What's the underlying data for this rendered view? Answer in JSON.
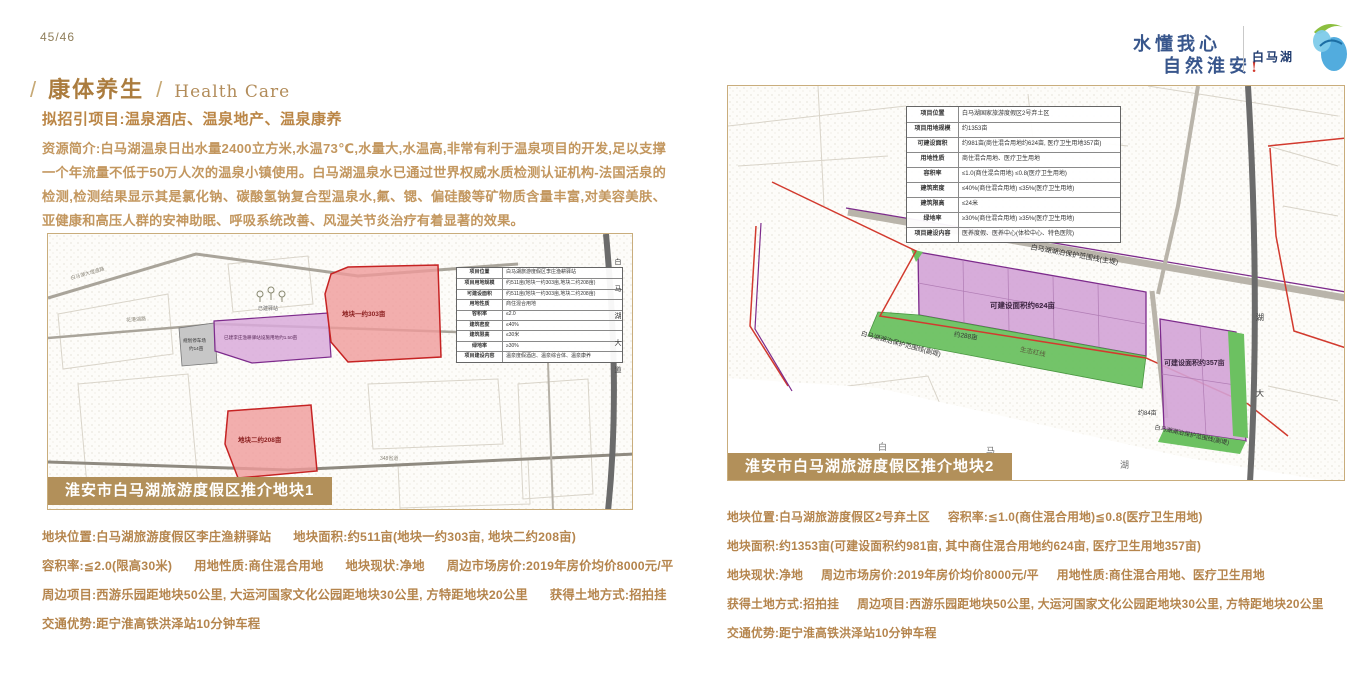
{
  "page": {
    "number": "45/46"
  },
  "header": {
    "slogan_line1": "水懂我心",
    "slogan_line2": "自然淮安",
    "slogan_mark": "!",
    "logo_text": "白马湖"
  },
  "section": {
    "slash": "/",
    "title_zh": "康体养生",
    "title_en": "Health Care",
    "subtitle": "拟招引项目:温泉酒店、温泉地产、温泉康养",
    "intro": "资源简介:白马湖温泉日出水量2400立方米,水温73℃,水量大,水温高,非常有利于温泉项目的开发,足以支撑一个年流量不低于50万人次的温泉小镇使用。白马湖温泉水已通过世界权威水质检测认证机构-法国活泉的检测,检测结果显示其是氯化钠、碳酸氢钠复合型温泉水,氟、锶、偏硅酸等矿物质含量丰富,对美容美肤、亚健康和高压人群的安神助眠、呼吸系统改善、风湿关节炎治疗有着显著的效果。"
  },
  "parcel1": {
    "caption": "淮安市白马湖旅游度假区推介地块1",
    "map_table": [
      {
        "k": "项目位置",
        "v": "白马湖旅游度假区李庄渔耕驿站"
      },
      {
        "k": "项目用地规模",
        "v": "约511亩(地块一约303亩,地块二约208亩)"
      },
      {
        "k": "可建设面积",
        "v": "约511亩(地块一约303亩,地块二约208亩)"
      },
      {
        "k": "用地性质",
        "v": "商住混合用地"
      },
      {
        "k": "容积率",
        "v": "≤2.0"
      },
      {
        "k": "建筑密度",
        "v": "≤40%"
      },
      {
        "k": "建筑限高",
        "v": "≤30米"
      },
      {
        "k": "绿地率",
        "v": "≥30%"
      },
      {
        "k": "项目建设内容",
        "v": "温泉度假酒店、温泉综合体、温泉康养"
      }
    ],
    "map_labels": {
      "road_top": "白马湖大堤道路",
      "road_mid": "花港湖路",
      "road_348": "348省道",
      "road_vertical": "白马湖大道",
      "parcel_a": "地块一约303亩",
      "parcel_b": "地块二约208亩",
      "built_station": "已建驿站",
      "built_strip": "已建李庄渔耕驿站设施用地约1.50亩",
      "parking_1": "规划停车场",
      "parking_2": "约14亩"
    },
    "details": [
      {
        "segments": [
          {
            "label": "地块位置:",
            "value": "白马湖旅游度假区李庄渔耕驿站"
          },
          {
            "label": "地块面积:",
            "value": "约511亩(地块一约303亩, 地块二约208亩)"
          }
        ]
      },
      {
        "segments": [
          {
            "label": "容积率:",
            "value": "≦2.0(限高30米)"
          },
          {
            "label": "用地性质:",
            "value": "商住混合用地"
          },
          {
            "label": "地块现状:",
            "value": "净地"
          },
          {
            "label": "周边市场房价:",
            "value": "2019年房价均价8000元/平"
          }
        ]
      },
      {
        "segments": [
          {
            "label": "周边项目:",
            "value": "西游乐园距地块50公里, 大运河国家文化公园距地块30公里, 方特距地块20公里"
          },
          {
            "label": "获得土地方式:",
            "value": "招拍挂"
          }
        ]
      },
      {
        "segments": [
          {
            "label": "交通优势:",
            "value": "距宁淮高铁洪泽站10分钟车程"
          }
        ]
      }
    ]
  },
  "parcel2": {
    "caption": "淮安市白马湖旅游度假区推介地块2",
    "map_table": [
      {
        "k": "项目位置",
        "v": "白马湖国家旅游度假区2号弃土区"
      },
      {
        "k": "项目用地规模",
        "v": "约1353亩"
      },
      {
        "k": "可建设面积",
        "v": "约981亩(商住混合用地约624亩, 医疗卫生用地357亩)"
      },
      {
        "k": "用地性质",
        "v": "商住混合用地、医疗卫生用地"
      },
      {
        "k": "容积率",
        "v": "≤1.0(商住混合用地) ≤0.8(医疗卫生用地)"
      },
      {
        "k": "建筑密度",
        "v": "≤40%(商住混合用地) ≤35%(医疗卫生用地)"
      },
      {
        "k": "建筑限高",
        "v": "≤24米"
      },
      {
        "k": "绿地率",
        "v": "≥30%(商住混合用地) ≥35%(医疗卫生用地)"
      },
      {
        "k": "项目建设内容",
        "v": "医养度假、医养中心(体检中心、特色医院)"
      }
    ],
    "map_labels": {
      "protect_main": "白马湖湖泊保护范围线(主堤)",
      "buildable_624": "可建设面积约624亩",
      "area_288": "约288亩",
      "eco_line": "生态红线",
      "protect_sub_left": "白马湖湖泊保护范围线(副堤)",
      "buildable_357": "可建设面积约357亩",
      "area_84": "约84亩",
      "protect_sub_right": "白马湖湖泊保护范围线(副堤)",
      "lake_char_1": "白",
      "lake_char_2": "马",
      "lake_char_3": "湖",
      "road_char_1": "湖",
      "road_char_2": "大"
    },
    "details": [
      {
        "segments": [
          {
            "label": "地块位置:",
            "value": "白马湖旅游度假区2号弃土区"
          },
          {
            "label": "容积率:",
            "value": "≦1.0(商住混合用地)≦0.8(医疗卫生用地)"
          }
        ]
      },
      {
        "segments": [
          {
            "label": "地块面积:",
            "value": "约1353亩(可建设面积约981亩, 其中商住混合用地约624亩, 医疗卫生用地357亩)"
          }
        ]
      },
      {
        "segments": [
          {
            "label": "地块现状:",
            "value": "净地"
          },
          {
            "label": "周边市场房价:",
            "value": "2019年房价均价8000元/平"
          },
          {
            "label": "用地性质:",
            "value": "商住混合用地、医疗卫生用地"
          }
        ]
      },
      {
        "segments": [
          {
            "label": "获得土地方式:",
            "value": "招拍挂"
          },
          {
            "label": "周边项目:",
            "value": "西游乐园距地块50公里, 大运河国家文化公园距地块30公里, 方特距地块20公里"
          }
        ]
      },
      {
        "segments": [
          {
            "label": "交通优势:",
            "value": "距宁淮高铁洪泽站10分钟车程"
          }
        ]
      }
    ]
  },
  "colors": {
    "band_tan": "#b2905a",
    "text_gold": "#b5854d",
    "slogan_blue": "#38568c",
    "parcel_red": "#c62323",
    "parcel_purple": "#7d2b8c",
    "parcel_green": "#6cc161"
  }
}
